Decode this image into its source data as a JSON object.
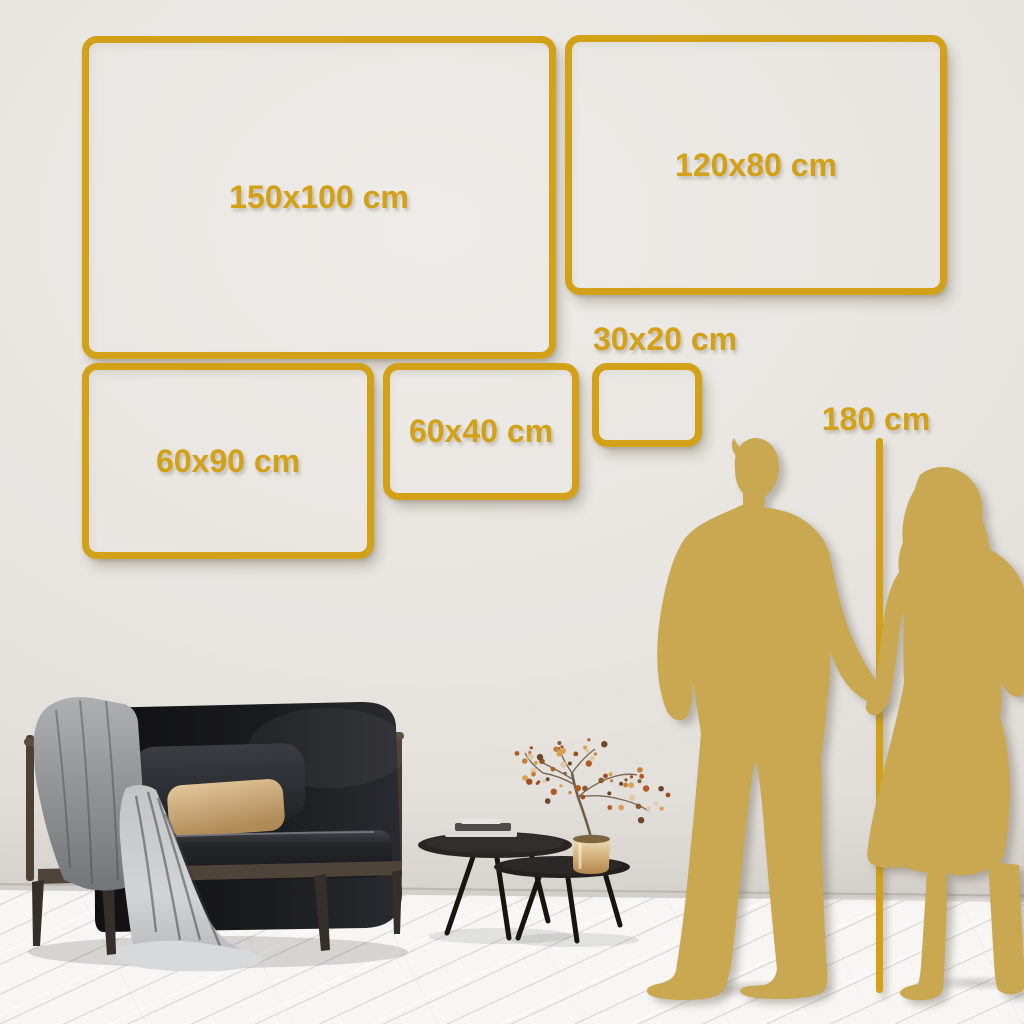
{
  "frames": [
    {
      "id": "150x100",
      "label": "150x100 cm"
    },
    {
      "id": "120x80",
      "label": "120x80 cm"
    },
    {
      "id": "60x90",
      "label": "60x90 cm"
    },
    {
      "id": "60x40",
      "label": "60x40 cm"
    },
    {
      "id": "30x20",
      "label": "30x20 cm"
    }
  ],
  "height_marker": {
    "label": "180 cm"
  },
  "colors": {
    "accent_gold": "#d2a118",
    "silhouette_gold": "#c9a851",
    "wall": "#e7e4e0",
    "floor": "#f4f3f1"
  }
}
